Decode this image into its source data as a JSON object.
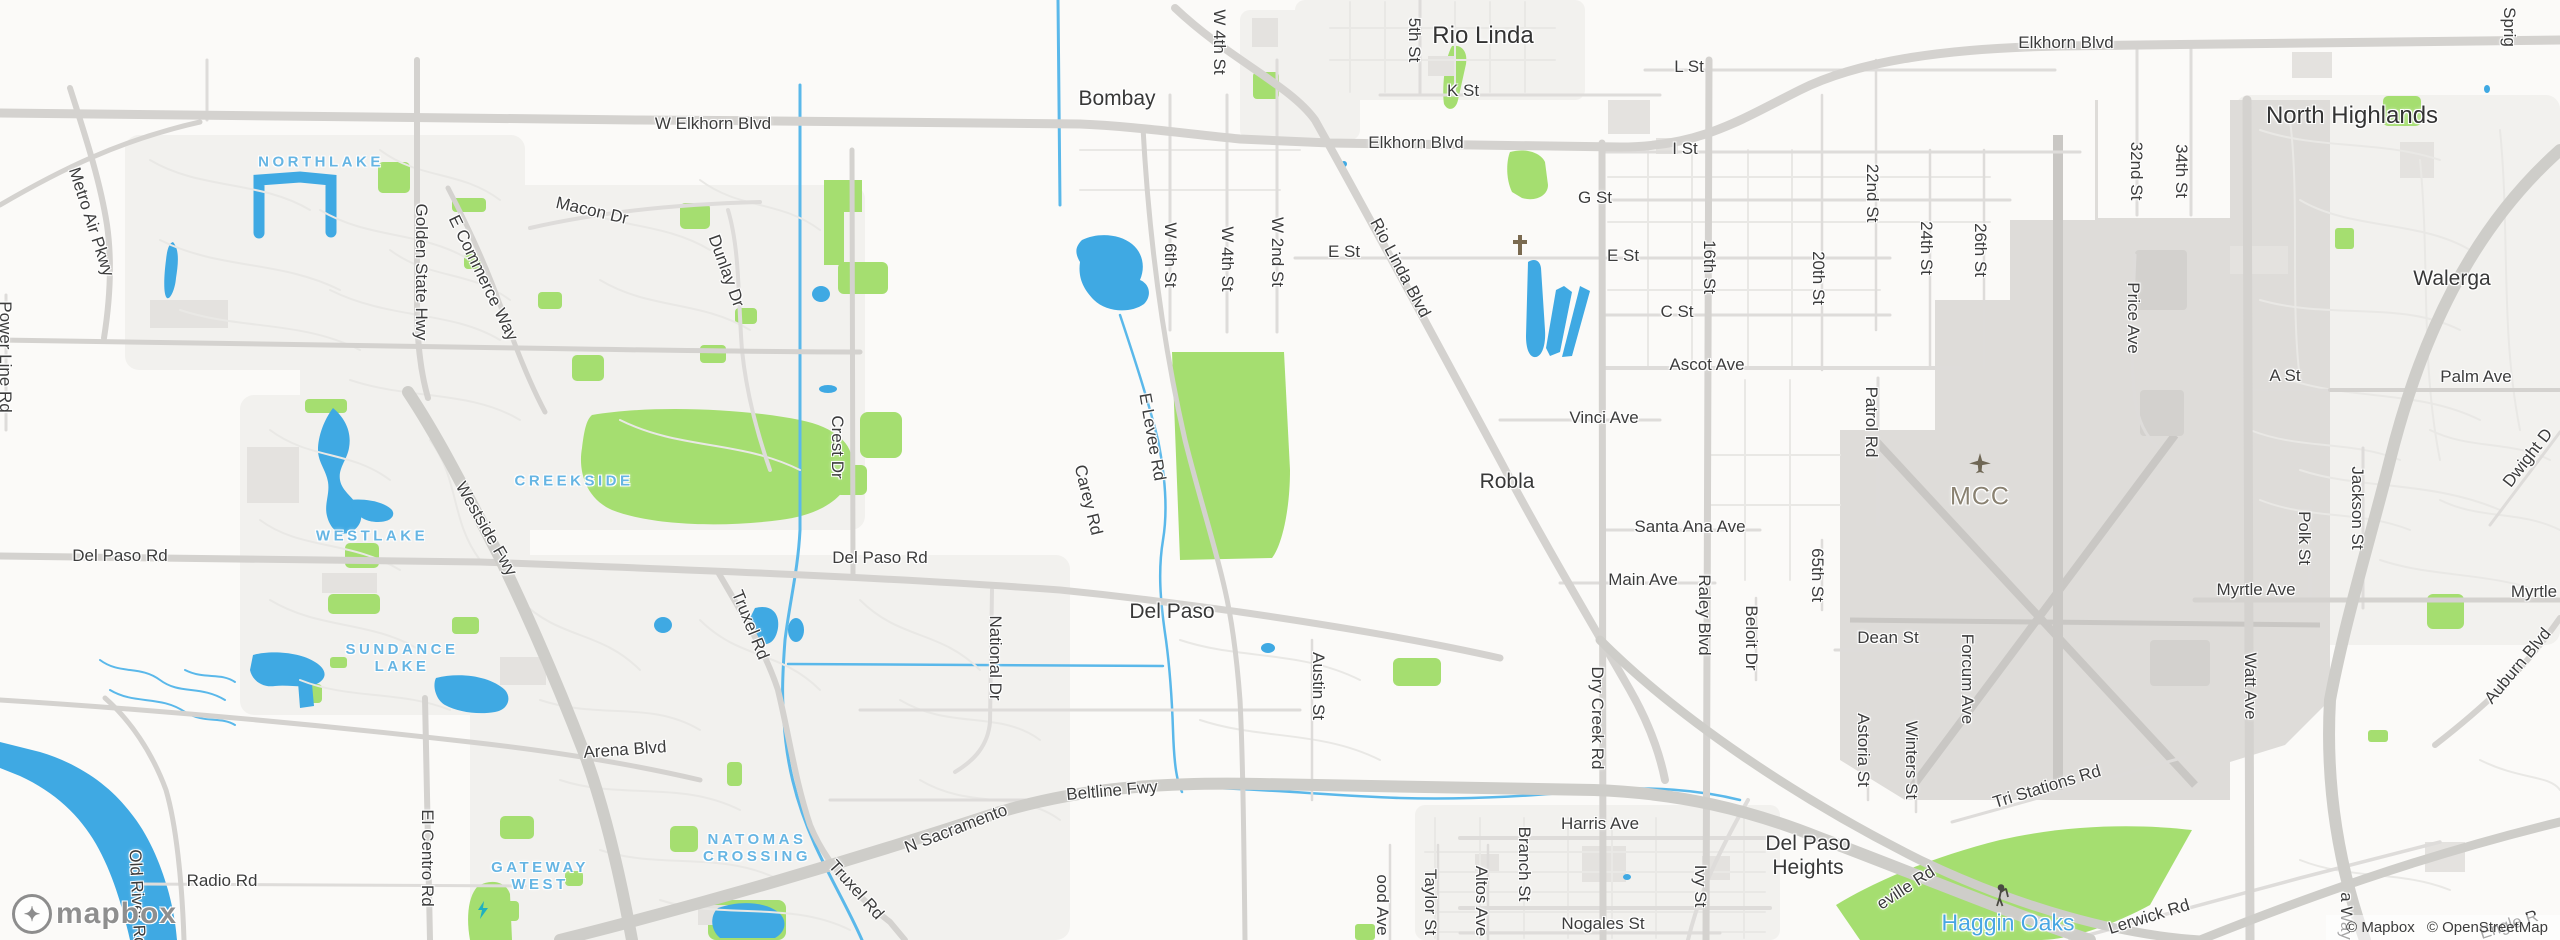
{
  "map": {
    "colors": {
      "land": "#fbfaf8",
      "urban": "#f2f1ee",
      "park": "#a5de70",
      "water": "#3fa9e3",
      "waterline": "#5ab8ea",
      "building": "#e4e2df",
      "airport": "#dedcd9",
      "runway": "#c9c7c4",
      "roadMinor": "#e9e8e5",
      "roadMed": "#dedcda",
      "roadMajor": "#d4d2cf",
      "freeway": "#cecdc9",
      "labelDark": "#3c3c3c",
      "labelBlue": "#66b5e3",
      "labelPoi": "#8a8272"
    },
    "logo": {
      "wordmark": "mapbox"
    },
    "attribution": {
      "mapbox": "© Mapbox",
      "osm": "© OpenStreetMap"
    },
    "labels": [
      {
        "name": "city-rio-linda",
        "text": "Rio Linda",
        "x": 1483,
        "y": 36,
        "r": 0,
        "t": "city"
      },
      {
        "name": "city-north-highlands",
        "text": "North Highlands",
        "x": 2352,
        "y": 116,
        "r": 0,
        "t": "city"
      },
      {
        "name": "town-bombay",
        "text": "Bombay",
        "x": 1117,
        "y": 99,
        "r": 0,
        "t": "town"
      },
      {
        "name": "town-walerga",
        "text": "Walerga",
        "x": 2452,
        "y": 279,
        "r": 0,
        "t": "town"
      },
      {
        "name": "town-robla",
        "text": "Robla",
        "x": 1507,
        "y": 482,
        "r": 0,
        "t": "town"
      },
      {
        "name": "town-del-paso",
        "text": "Del Paso",
        "x": 1172,
        "y": 612,
        "r": 0,
        "t": "town"
      },
      {
        "name": "town-del-paso-heights",
        "text": "Del Paso\nHeights",
        "x": 1808,
        "y": 856,
        "r": 0,
        "t": "town"
      },
      {
        "name": "hood-northlake",
        "text": "NORTHLAKE",
        "x": 321,
        "y": 162,
        "r": 0,
        "t": "hood"
      },
      {
        "name": "hood-creekside",
        "text": "CREEKSIDE",
        "x": 574,
        "y": 481,
        "r": 0,
        "t": "hood"
      },
      {
        "name": "hood-westlake",
        "text": "WESTLAKE",
        "x": 372,
        "y": 536,
        "r": 0,
        "t": "hood"
      },
      {
        "name": "hood-sundance-lake",
        "text": "SUNDANCE\nLAKE",
        "x": 402,
        "y": 658,
        "r": 0,
        "t": "hood"
      },
      {
        "name": "hood-natomas-crossing",
        "text": "NATOMAS\nCROSSING",
        "x": 757,
        "y": 848,
        "r": 0,
        "t": "hood"
      },
      {
        "name": "hood-gateway-west",
        "text": "GATEWAY\nWEST",
        "x": 540,
        "y": 876,
        "r": 0,
        "t": "hood"
      },
      {
        "name": "poi-haggin-oaks",
        "text": "Haggin Oaks",
        "x": 2008,
        "y": 923,
        "r": 0,
        "t": "water"
      },
      {
        "name": "poi-mcc",
        "text": "MCC",
        "x": 1980,
        "y": 497,
        "r": 0,
        "t": "mcc"
      },
      {
        "name": "road-w-elkhorn-blvd",
        "text": "W Elkhorn Blvd",
        "x": 713,
        "y": 124,
        "r": 0,
        "t": "road"
      },
      {
        "name": "road-elkhorn-blvd-center",
        "text": "Elkhorn Blvd",
        "x": 1416,
        "y": 143,
        "r": 0,
        "t": "road"
      },
      {
        "name": "road-elkhorn-blvd-east",
        "text": "Elkhorn Blvd",
        "x": 2066,
        "y": 43,
        "r": 0,
        "t": "road"
      },
      {
        "name": "road-l-st",
        "text": "L St",
        "x": 1689,
        "y": 67,
        "r": 0,
        "t": "road"
      },
      {
        "name": "road-k-st",
        "text": "K St",
        "x": 1463,
        "y": 91,
        "r": 0,
        "t": "road"
      },
      {
        "name": "road-i-st",
        "text": "I St",
        "x": 1685,
        "y": 149,
        "r": 0,
        "t": "road"
      },
      {
        "name": "road-g-st",
        "text": "G St",
        "x": 1595,
        "y": 198,
        "r": 0,
        "t": "road"
      },
      {
        "name": "road-e-st-west",
        "text": "E St",
        "x": 1344,
        "y": 252,
        "r": 0,
        "t": "road"
      },
      {
        "name": "road-e-st-east",
        "text": "E St",
        "x": 1623,
        "y": 256,
        "r": 0,
        "t": "road"
      },
      {
        "name": "road-c-st",
        "text": "C St",
        "x": 1677,
        "y": 312,
        "r": 0,
        "t": "road"
      },
      {
        "name": "road-ascot-ave",
        "text": "Ascot Ave",
        "x": 1707,
        "y": 365,
        "r": 0,
        "t": "road"
      },
      {
        "name": "road-vinci-ave",
        "text": "Vinci Ave",
        "x": 1604,
        "y": 418,
        "r": 0,
        "t": "road"
      },
      {
        "name": "road-santa-ana-ave",
        "text": "Santa Ana Ave",
        "x": 1690,
        "y": 527,
        "r": 0,
        "t": "road"
      },
      {
        "name": "road-main-ave",
        "text": "Main Ave",
        "x": 1643,
        "y": 580,
        "r": 0,
        "t": "road"
      },
      {
        "name": "road-dean-st",
        "text": "Dean St",
        "x": 1888,
        "y": 638,
        "r": 0,
        "t": "road"
      },
      {
        "name": "road-harris-ave",
        "text": "Harris Ave",
        "x": 1600,
        "y": 824,
        "r": 0,
        "t": "road"
      },
      {
        "name": "road-nogales-st",
        "text": "Nogales St",
        "x": 1603,
        "y": 924,
        "r": 0,
        "t": "road"
      },
      {
        "name": "road-del-paso-rd-west",
        "text": "Del Paso Rd",
        "x": 120,
        "y": 556,
        "r": 0,
        "t": "road"
      },
      {
        "name": "road-del-paso-rd-center",
        "text": "Del Paso Rd",
        "x": 880,
        "y": 558,
        "r": 0,
        "t": "road"
      },
      {
        "name": "road-arena-blvd",
        "text": "Arena Blvd",
        "x": 625,
        "y": 750,
        "r": -4,
        "t": "road"
      },
      {
        "name": "road-radio-rd",
        "text": "Radio Rd",
        "x": 222,
        "y": 881,
        "r": 0,
        "t": "road"
      },
      {
        "name": "road-myrtle-ave",
        "text": "Myrtle Ave",
        "x": 2256,
        "y": 590,
        "r": 0,
        "t": "road"
      },
      {
        "name": "road-myrtle-ave-east",
        "text": "Myrtle",
        "x": 2534,
        "y": 592,
        "r": 0,
        "t": "road"
      },
      {
        "name": "road-a-st",
        "text": "A St",
        "x": 2285,
        "y": 376,
        "r": 0,
        "t": "road"
      },
      {
        "name": "road-palm-ave",
        "text": "Palm Ave",
        "x": 2476,
        "y": 377,
        "r": 0,
        "t": "road"
      },
      {
        "name": "road-n-sacramento",
        "text": "N Sacramento",
        "x": 956,
        "y": 829,
        "r": -21,
        "t": "road"
      },
      {
        "name": "road-beltline-fwy",
        "text": "Beltline Fwy",
        "x": 1112,
        "y": 791,
        "r": -5,
        "t": "road"
      },
      {
        "name": "road-5th-st",
        "text": "5th St",
        "x": 1414,
        "y": 40,
        "r": 90,
        "t": "road"
      },
      {
        "name": "road-w-4th-st-north",
        "text": "W 4th St",
        "x": 1219,
        "y": 42,
        "r": 90,
        "t": "road"
      },
      {
        "name": "road-w-6th-st",
        "text": "W 6th St",
        "x": 1170,
        "y": 255,
        "r": 90,
        "t": "road"
      },
      {
        "name": "road-w-4th-st",
        "text": "W 4th St",
        "x": 1227,
        "y": 259,
        "r": 90,
        "t": "road"
      },
      {
        "name": "road-w-2nd-st",
        "text": "W 2nd St",
        "x": 1277,
        "y": 252,
        "r": 90,
        "t": "road"
      },
      {
        "name": "road-rio-linda-blvd",
        "text": "Rio Linda Blvd",
        "x": 1400,
        "y": 268,
        "r": 62,
        "t": "road"
      },
      {
        "name": "road-e-levee-rd",
        "text": "E Levee Rd",
        "x": 1152,
        "y": 437,
        "r": 80,
        "t": "road"
      },
      {
        "name": "road-carey-rd",
        "text": "Carey Rd",
        "x": 1088,
        "y": 500,
        "r": 76,
        "t": "road"
      },
      {
        "name": "road-national-dr",
        "text": "National Dr",
        "x": 995,
        "y": 658,
        "r": 90,
        "t": "road"
      },
      {
        "name": "road-austin-st",
        "text": "Austin St",
        "x": 1318,
        "y": 686,
        "r": 90,
        "t": "road"
      },
      {
        "name": "road-truxel-rd-north",
        "text": "Truxel Rd",
        "x": 750,
        "y": 625,
        "r": 68,
        "t": "road"
      },
      {
        "name": "road-truxel-rd-south",
        "text": "Truxel Rd",
        "x": 856,
        "y": 890,
        "r": 48,
        "t": "road"
      },
      {
        "name": "road-16th-st",
        "text": "16th St",
        "x": 1709,
        "y": 267,
        "r": 90,
        "t": "road"
      },
      {
        "name": "road-20th-st",
        "text": "20th St",
        "x": 1818,
        "y": 278,
        "r": 90,
        "t": "road"
      },
      {
        "name": "road-22nd-st",
        "text": "22nd St",
        "x": 1872,
        "y": 193,
        "r": 90,
        "t": "road"
      },
      {
        "name": "road-24th-st",
        "text": "24th St",
        "x": 1926,
        "y": 248,
        "r": 90,
        "t": "road"
      },
      {
        "name": "road-26th-st",
        "text": "26th St",
        "x": 1980,
        "y": 250,
        "r": 90,
        "t": "road"
      },
      {
        "name": "road-32nd-st",
        "text": "32nd St",
        "x": 2136,
        "y": 171,
        "r": 90,
        "t": "road"
      },
      {
        "name": "road-34th-st",
        "text": "34th St",
        "x": 2181,
        "y": 171,
        "r": 90,
        "t": "road"
      },
      {
        "name": "road-patrol-rd",
        "text": "Patrol Rd",
        "x": 1871,
        "y": 422,
        "r": 90,
        "t": "road"
      },
      {
        "name": "road-price-ave",
        "text": "Price Ave",
        "x": 2133,
        "y": 318,
        "r": 90,
        "t": "road"
      },
      {
        "name": "road-65th-st",
        "text": "65th St",
        "x": 1817,
        "y": 575,
        "r": 90,
        "t": "road"
      },
      {
        "name": "road-raley-blvd",
        "text": "Raley Blvd",
        "x": 1704,
        "y": 615,
        "r": 90,
        "t": "road"
      },
      {
        "name": "road-beloit-dr",
        "text": "Beloit Dr",
        "x": 1751,
        "y": 638,
        "r": 90,
        "t": "road"
      },
      {
        "name": "road-forcum-ave",
        "text": "Forcum Ave",
        "x": 1967,
        "y": 679,
        "r": 90,
        "t": "road"
      },
      {
        "name": "road-astoria-st",
        "text": "Astoria St",
        "x": 1863,
        "y": 750,
        "r": 90,
        "t": "road"
      },
      {
        "name": "road-winters-st",
        "text": "Winters St",
        "x": 1911,
        "y": 760,
        "r": 90,
        "t": "road"
      },
      {
        "name": "road-dry-creek-rd",
        "text": "Dry Creek Rd",
        "x": 1597,
        "y": 718,
        "r": 90,
        "t": "road"
      },
      {
        "name": "road-branch-st",
        "text": "Branch St",
        "x": 1524,
        "y": 864,
        "r": 90,
        "t": "road"
      },
      {
        "name": "road-altos-ave",
        "text": "Altos Ave",
        "x": 1481,
        "y": 901,
        "r": 90,
        "t": "road"
      },
      {
        "name": "road-taylor-st",
        "text": "Taylor St",
        "x": 1430,
        "y": 902,
        "r": 90,
        "t": "road"
      },
      {
        "name": "road-wood-ave-partial",
        "text": "ood Ave",
        "x": 1382,
        "y": 905,
        "r": 90,
        "t": "road"
      },
      {
        "name": "road-ivy-st",
        "text": "Ivy St",
        "x": 1700,
        "y": 886,
        "r": 90,
        "t": "road"
      },
      {
        "name": "road-watt-ave",
        "text": "Watt Ave",
        "x": 2250,
        "y": 686,
        "r": 90,
        "t": "road"
      },
      {
        "name": "road-polk-st",
        "text": "Polk St",
        "x": 2304,
        "y": 538,
        "r": 90,
        "t": "road"
      },
      {
        "name": "road-jackson-st",
        "text": "Jackson St",
        "x": 2357,
        "y": 508,
        "r": 90,
        "t": "road"
      },
      {
        "name": "road-el-centro-rd",
        "text": "El Centro Rd",
        "x": 427,
        "y": 858,
        "r": 90,
        "t": "road"
      },
      {
        "name": "road-old-river-rd",
        "text": "Old River Rd",
        "x": 137,
        "y": 898,
        "r": 87,
        "t": "road"
      },
      {
        "name": "road-power-line-rd",
        "text": "Power Line Rd",
        "x": 5,
        "y": 357,
        "r": 90,
        "t": "road"
      },
      {
        "name": "road-metro-air-pkwy",
        "text": "Metro Air Pkwy",
        "x": 91,
        "y": 222,
        "r": 72,
        "t": "road"
      },
      {
        "name": "road-golden-state-hwy",
        "text": "Golden State Hwy",
        "x": 421,
        "y": 272,
        "r": 90,
        "t": "road"
      },
      {
        "name": "road-e-commerce-way",
        "text": "E Commerce Way",
        "x": 483,
        "y": 278,
        "r": 64,
        "t": "road"
      },
      {
        "name": "road-westside-fwy",
        "text": "Westside Fwy",
        "x": 486,
        "y": 529,
        "r": 60,
        "t": "road"
      },
      {
        "name": "road-macon-dr",
        "text": "Macon Dr",
        "x": 592,
        "y": 211,
        "r": 13,
        "t": "road"
      },
      {
        "name": "road-dunlay-dr",
        "text": "Dunlay Dr",
        "x": 726,
        "y": 271,
        "r": 70,
        "t": "road"
      },
      {
        "name": "road-crest-dr",
        "text": "Crest Dr",
        "x": 837,
        "y": 447,
        "r": 90,
        "t": "road"
      },
      {
        "name": "road-tri-stations-rd",
        "text": "Tri Stations Rd",
        "x": 2047,
        "y": 787,
        "r": -17,
        "t": "road"
      },
      {
        "name": "road-lerwick-rd",
        "text": "Lerwick Rd",
        "x": 2149,
        "y": 917,
        "r": -17,
        "t": "road"
      },
      {
        "name": "road-roseville-rd-partial",
        "text": "eville Rd",
        "x": 1906,
        "y": 888,
        "r": -33,
        "t": "road"
      },
      {
        "name": "road-auburn-blvd",
        "text": "Auburn Blvd",
        "x": 2518,
        "y": 666,
        "r": -50,
        "t": "road"
      },
      {
        "name": "road-dwight-partial",
        "text": "Dwight D",
        "x": 2528,
        "y": 458,
        "r": -52,
        "t": "road"
      },
      {
        "name": "road-sprig-partial",
        "text": "Sprig",
        "x": 2509,
        "y": 27,
        "r": 90,
        "t": "road"
      },
      {
        "name": "road-way-partial",
        "text": "a Way",
        "x": 2346,
        "y": 916,
        "r": 90,
        "t": "road"
      },
      {
        "name": "road-engle-rd-partial",
        "text": "Engle R",
        "x": 2509,
        "y": 925,
        "r": -18,
        "t": "road"
      },
      {
        "name": "airplane-icon",
        "icon": "plane",
        "x": 1980,
        "y": 464,
        "r": 0,
        "t": "icon"
      },
      {
        "name": "golfer-icon",
        "icon": "golfer",
        "x": 2004,
        "y": 897,
        "r": 0,
        "t": "icon"
      },
      {
        "name": "cross-icon",
        "icon": "cross",
        "x": 1524,
        "y": 247,
        "r": 0,
        "t": "icon"
      },
      {
        "name": "bolt-icon",
        "icon": "bolt",
        "x": 489,
        "y": 914,
        "r": 0,
        "t": "icon"
      }
    ]
  }
}
